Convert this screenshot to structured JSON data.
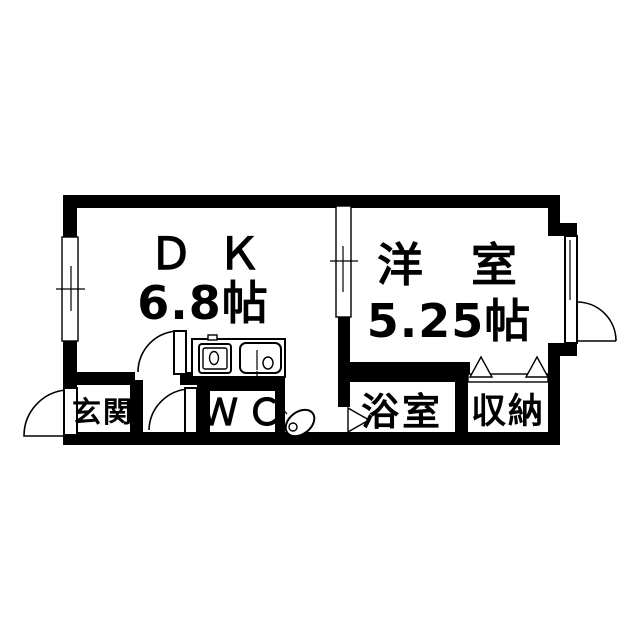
{
  "floorplan": {
    "title": "1DK apartment floor plan",
    "rooms": [
      {
        "id": "dk",
        "name": "ＤＫ",
        "size": "6.8帖"
      },
      {
        "id": "youshitsu",
        "name": "洋 室",
        "size": "5.25帖"
      },
      {
        "id": "genkan",
        "name": "玄関"
      },
      {
        "id": "wc",
        "name": "ＷＣ"
      },
      {
        "id": "bath",
        "name": "浴室"
      },
      {
        "id": "closet",
        "name": "収納"
      }
    ],
    "symbols": [
      "door-swing-arc-icon",
      "window-double-line-icon",
      "folding-door-triangle-icon",
      "kitchen-sink-icon",
      "stove-icon",
      "toilet-icon"
    ],
    "colors": {
      "wall": "#000000",
      "background": "#ffffff",
      "line": "#000000"
    }
  }
}
